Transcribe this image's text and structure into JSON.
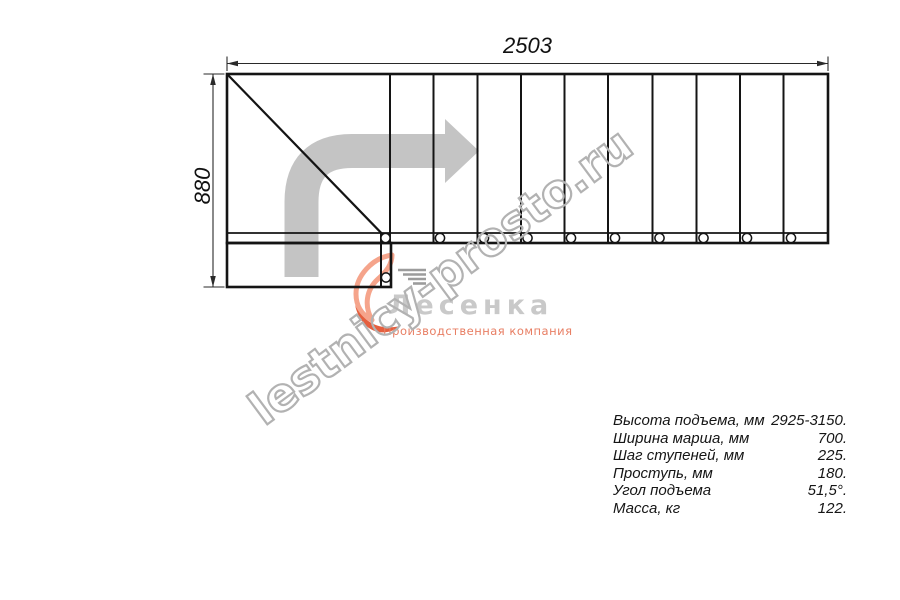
{
  "drawing": {
    "dim_width_label": "2503",
    "dim_height_label": "880",
    "watermark_text": "lestnicy-prosto.ru"
  },
  "logo": {
    "company_name": "Лесенка",
    "tagline": "Производственная компания"
  },
  "specs": {
    "rows": [
      {
        "label": "Высота подъема, мм",
        "value": "2925-3150."
      },
      {
        "label": "Ширина марша, мм",
        "value": "700."
      },
      {
        "label": "Шаг ступеней, мм",
        "value": "225."
      },
      {
        "label": "Проступь, мм",
        "value": "180."
      },
      {
        "label": "Угол подъема",
        "value": "51,5°."
      },
      {
        "label": "Масса, кг",
        "value": "122."
      }
    ]
  },
  "colors": {
    "line": "#141414",
    "dim_line": "#2a2a2a",
    "arrow_gray": "#c4c4c4",
    "watermark_gray": "#b2b2b2",
    "logo_flame_light": "#f5a48b",
    "logo_flame_dark": "#e55f3e",
    "logo_steps_gray": "#9c9c9c",
    "logo_text_gray": "#c9c9c9",
    "logo_tagline_coral": "#e87e63",
    "text": "#111111"
  },
  "diagram": {
    "main_rect": {
      "x": 227,
      "y": 74,
      "w": 601,
      "h": 169
    },
    "strip_line_y": 233,
    "dividers_x": [
      390,
      433.5,
      477.5,
      521,
      564.5,
      608,
      652.5,
      696.5,
      740,
      783.5
    ],
    "diagonal": [
      228,
      75,
      390,
      242
    ],
    "lower_rect": {
      "x": 227,
      "y": 243,
      "w": 164,
      "h": 44
    },
    "lower_divider": [
      381,
      233,
      381,
      287
    ],
    "circles_strip_x": [
      385.5,
      440,
      484,
      527.5,
      571,
      615,
      659.5,
      703.5,
      747,
      791
    ],
    "circle_y": 238,
    "circle_r": 4.6,
    "lower_circle": {
      "x": 386,
      "y": 277.5,
      "r": 4.6
    },
    "dim_lines": [
      [
        227,
        63.5,
        828,
        63.5
      ],
      [
        213,
        74,
        213,
        287
      ]
    ],
    "ext_lines": [
      [
        227,
        56.5,
        227,
        71
      ],
      [
        828,
        56.5,
        828,
        71
      ],
      [
        203.5,
        74,
        224.5,
        74
      ],
      [
        203.5,
        287,
        224.5,
        287
      ]
    ],
    "dim_arrowheads": [
      "227,63.5 238,60.7 238,66.3",
      "828,63.5 817,60.7 817,66.3",
      "213,74 210.2,85 215.8,85",
      "213,287 210.2,276 215.8,276"
    ],
    "arrow_path": "M 301.5 277 L 301.5 202 Q 301.5 151 352 151 L 445.5 151",
    "arrow_head_points": "445,119 479,151 445,183",
    "flame_light_path": "M 44 7 C 24 10 8 28 8 46 C 8 58 14 67 24 72 C 16 58 18 42 30 31 C 39 23 44 16 44 7 Z",
    "flame_dark_path": "M 7 57 C 15 74 32 83 52 78 C 40 89 14 88 7 57 Z",
    "steps_icon_lines": [
      [
        50,
        22,
        78,
        22
      ],
      [
        55,
        26.5,
        78,
        26.5
      ],
      [
        60,
        31,
        78,
        31
      ],
      [
        65,
        35.5,
        78,
        35.5
      ]
    ]
  }
}
